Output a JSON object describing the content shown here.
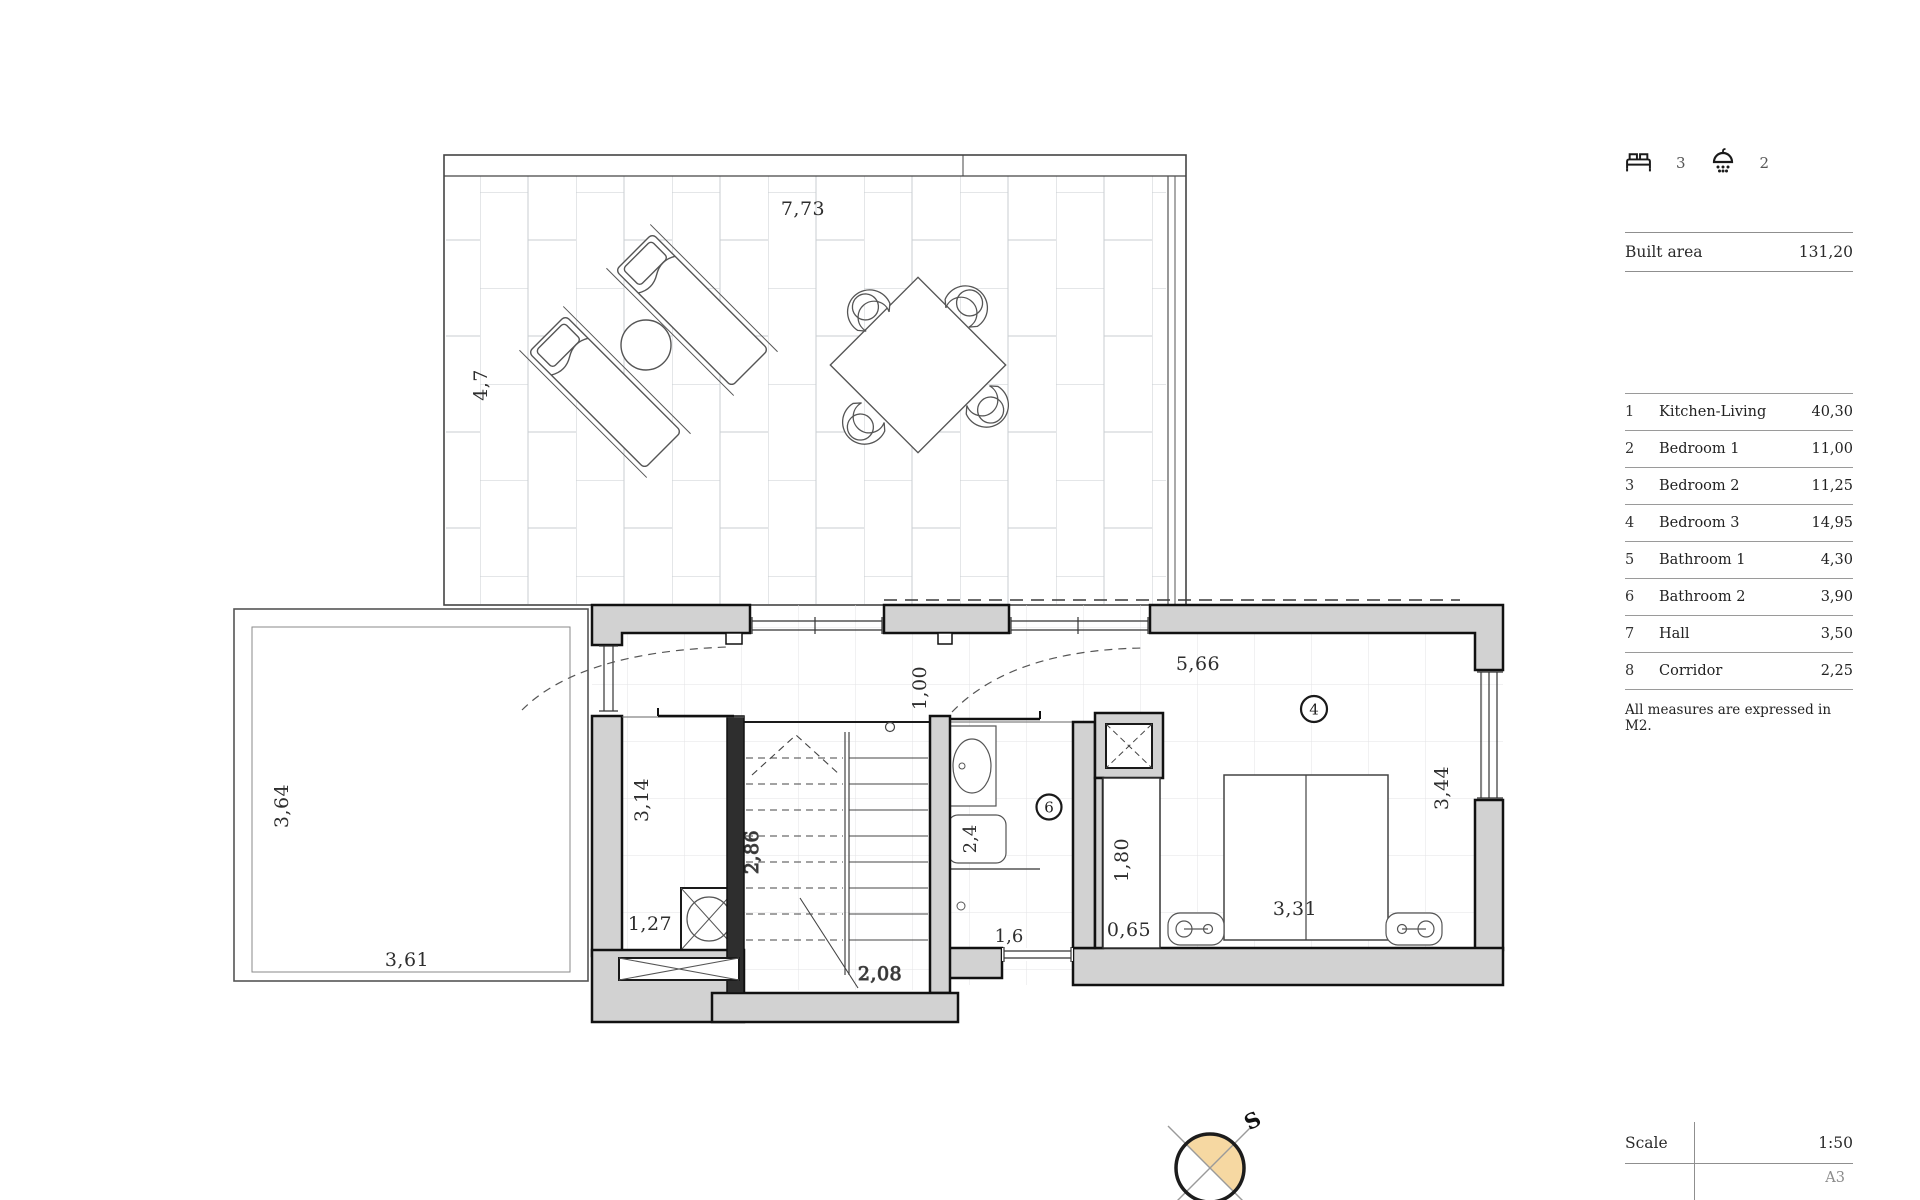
{
  "sidebar": {
    "bedrooms": "3",
    "bathrooms": "2",
    "built_area": {
      "label": "Built area",
      "value": "131,20"
    },
    "rooms": [
      {
        "num": "1",
        "name": "Kitchen-Living",
        "area": "40,30"
      },
      {
        "num": "2",
        "name": "Bedroom 1",
        "area": "11,00"
      },
      {
        "num": "3",
        "name": "Bedroom 2",
        "area": "11,25"
      },
      {
        "num": "4",
        "name": "Bedroom 3",
        "area": "14,95"
      },
      {
        "num": "5",
        "name": "Bathroom 1",
        "area": "4,30"
      },
      {
        "num": "6",
        "name": "Bathroom 2",
        "area": "3,90"
      },
      {
        "num": "7",
        "name": "Hall",
        "area": "3,50"
      },
      {
        "num": "8",
        "name": "Corridor",
        "area": "2,25"
      }
    ],
    "note": "All measures are expressed in M2.",
    "scale": {
      "label": "Scale",
      "value": "1:50",
      "paper": "A3"
    }
  },
  "plan": {
    "terrace": {
      "width": "7,73",
      "height": "4,7"
    },
    "patio": {
      "height": "3,64",
      "width": "3,61"
    },
    "storage": {
      "height": "3,14",
      "width": "1,27"
    },
    "stairs": {
      "height": "2,86",
      "width": "2,08"
    },
    "corridor": {
      "width": "1,00"
    },
    "bathroom2": {
      "number": "6",
      "tub": "2,4",
      "window": "1,6"
    },
    "bedroom3": {
      "number": "4",
      "top": "5,66",
      "right": "3,44",
      "closet_depth": "1,80",
      "closet_width": "0,65",
      "bed": "3,31"
    },
    "compass": {
      "label": "S"
    },
    "colors": {
      "wall_fill": "#d2d2d2",
      "compass_fill": "#f6d8a2",
      "line": "#111111"
    }
  }
}
